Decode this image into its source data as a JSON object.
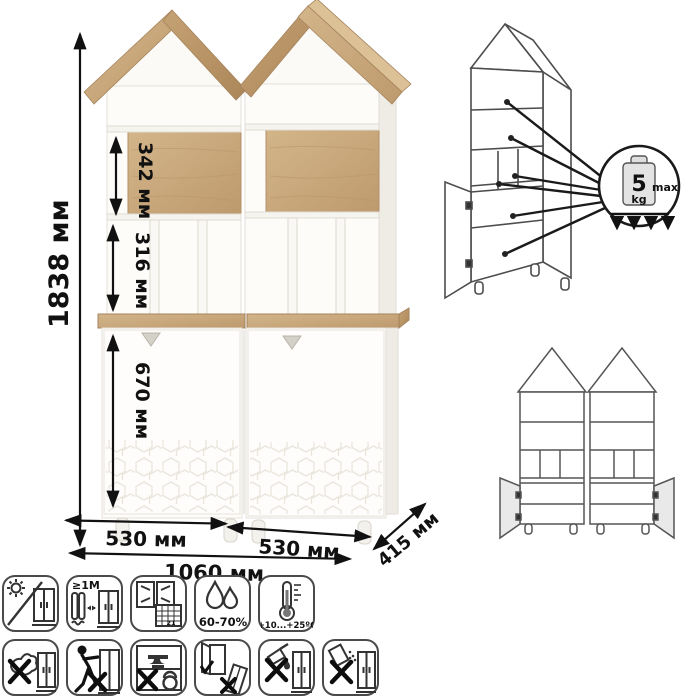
{
  "product_view": {
    "dims": {
      "total_height": "1838 мм",
      "upper_shelf": "342 мм",
      "middle_shelf": "316 мм",
      "door_section": "670 мм",
      "left_width": "530 мм",
      "right_width": "530 мм",
      "total_width": "1060 мм",
      "depth": "415 мм"
    }
  },
  "load_diagram": {
    "weight_value": "5",
    "weight_unit": "kg",
    "max_label": "max"
  },
  "care_icons": {
    "row1": [
      {
        "name": "no-direct-sunlight",
        "label": ""
      },
      {
        "name": "keep-1m-from-heat-sources",
        "label": "≥1M"
      },
      {
        "name": "acclimatize-ventilate-room",
        "label": "21"
      },
      {
        "name": "humidity-range",
        "label": "60-70%"
      },
      {
        "name": "temperature-range",
        "label": "+10...+25ºC"
      }
    ],
    "row2": [
      {
        "name": "do-not-wipe-with-wet-cloth"
      },
      {
        "name": "do-not-push-or-drag"
      },
      {
        "name": "do-not-overload-shelves"
      },
      {
        "name": "hang-doors-do-not-tilt"
      },
      {
        "name": "no-solvent-cleaners"
      },
      {
        "name": "no-abrasive-powders"
      }
    ]
  },
  "colors": {
    "wood": "#c9a87c",
    "wood_dark": "#b08d60",
    "body_white": "#fdfcf9",
    "dimension_line": "#1a1a1a",
    "drawing_line": "#4d4d4d"
  }
}
